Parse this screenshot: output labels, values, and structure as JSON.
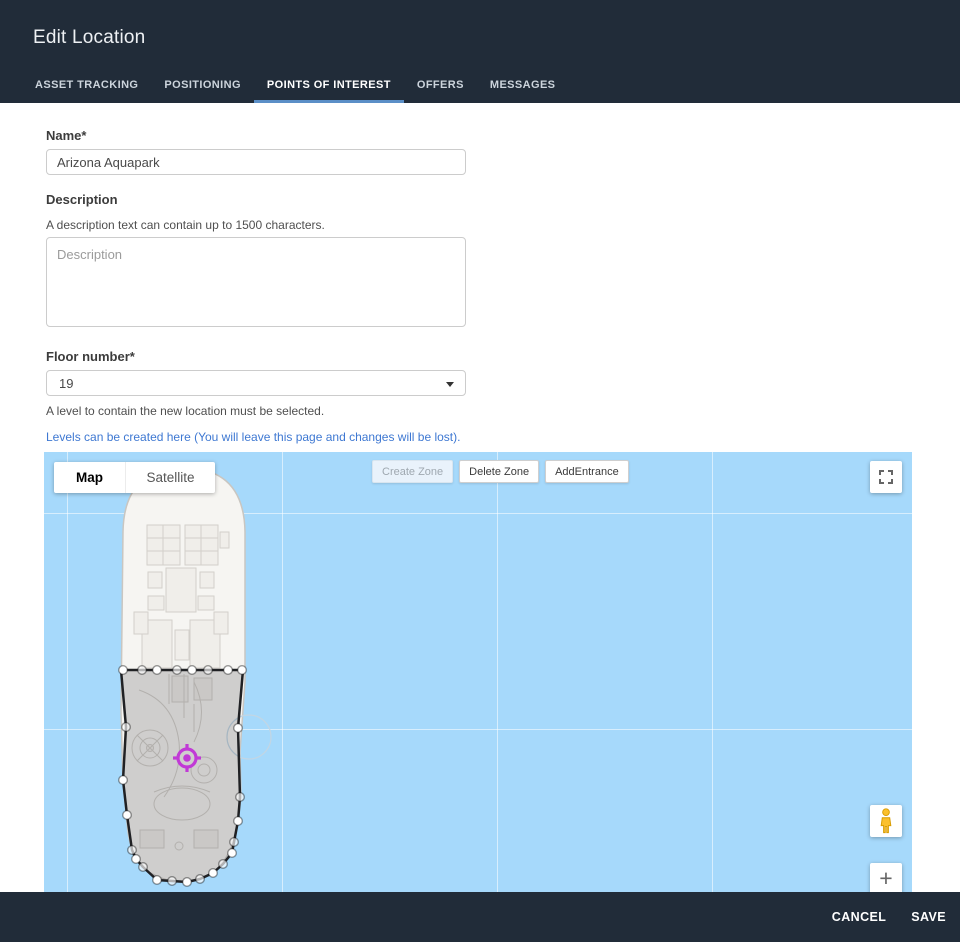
{
  "header": {
    "title": "Edit Location"
  },
  "tabs": [
    {
      "label": "ASSET TRACKING",
      "active": false
    },
    {
      "label": "POSITIONING",
      "active": false
    },
    {
      "label": "POINTS OF INTEREST",
      "active": true
    },
    {
      "label": "OFFERS",
      "active": false
    },
    {
      "label": "MESSAGES",
      "active": false
    }
  ],
  "form": {
    "name": {
      "label": "Name*",
      "value": "Arizona Aquapark"
    },
    "description": {
      "label": "Description",
      "helper": "A description text can contain up to 1500 characters.",
      "placeholder": "Description"
    },
    "floor": {
      "label": "Floor number*",
      "value": "19",
      "helper": "A level to contain the new location must be selected.",
      "link_text": "Levels can be created here (You will leave this page and changes will be lost)."
    }
  },
  "map": {
    "map_type_map": "Map",
    "map_type_satellite": "Satellite",
    "buttons": {
      "create_zone": "Create Zone",
      "delete_zone": "Delete Zone",
      "add_entrance": "AddEntrance"
    },
    "zoom_in_label": "+",
    "colors": {
      "water": "#a6d9fb",
      "zone_stroke": "#202124",
      "zone_fill": "rgba(70,70,75,0.22)",
      "marker": "#c13ad6",
      "tab_accent": "#5b8fc7",
      "bar_bg": "#212c39",
      "pegman": "#fbc02d"
    }
  },
  "footer": {
    "cancel": "CANCEL",
    "save": "SAVE"
  }
}
